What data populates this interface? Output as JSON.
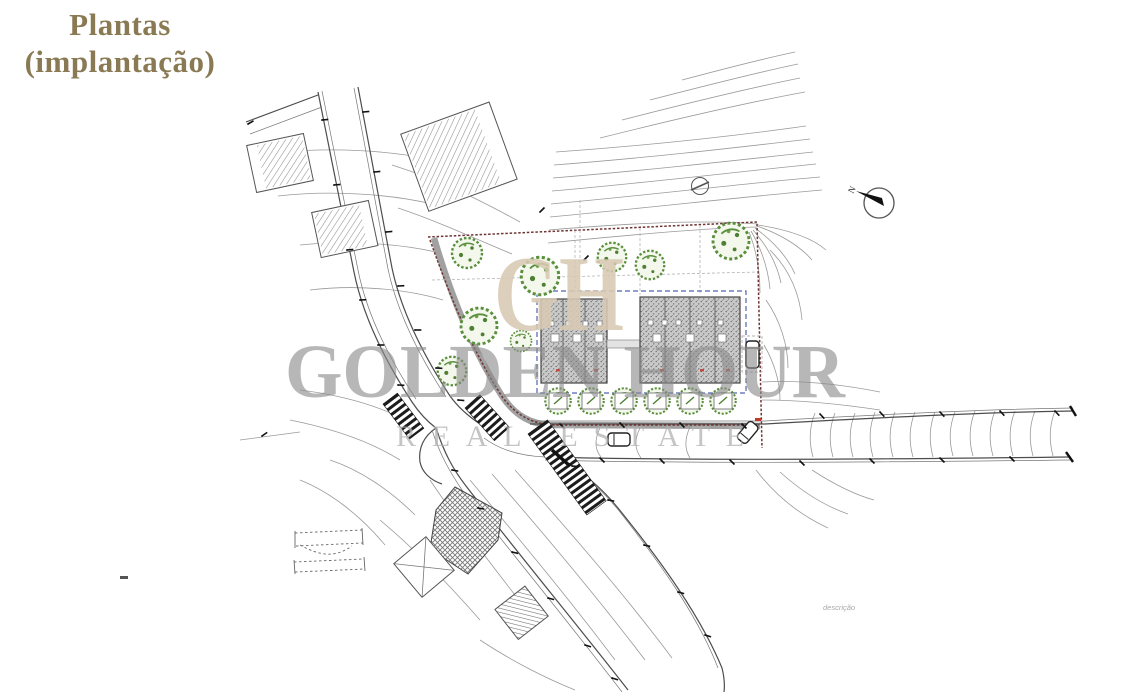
{
  "page": {
    "title": {
      "line1": "Plantas",
      "line2": "(implantação)"
    }
  },
  "watermark": {
    "monogram": "GH",
    "primary": "GOLDEN HOUR",
    "secondary": "REAL ESTATE"
  },
  "plan": {
    "compass_label": "N",
    "caption": "descrição"
  },
  "colors": {
    "title": "#8a7a54",
    "watermark-monogram": "#d8cab4",
    "watermark-text": "#8c8c8c",
    "watermark-sub": "#b2b2b2",
    "boundary": "#6e3434",
    "setback": "#4f63b0",
    "tree": "#5a8f3c",
    "tree-fill": "#f3f7ec",
    "roof-dot": "#6e6e6e",
    "roof-base": "#c9c9c9",
    "hatch": "#8f8f8f",
    "line": "#4d4d4d",
    "contour": "#9a9a9a",
    "curb": "#8a8a8a",
    "accent-red": "#c0392b"
  }
}
